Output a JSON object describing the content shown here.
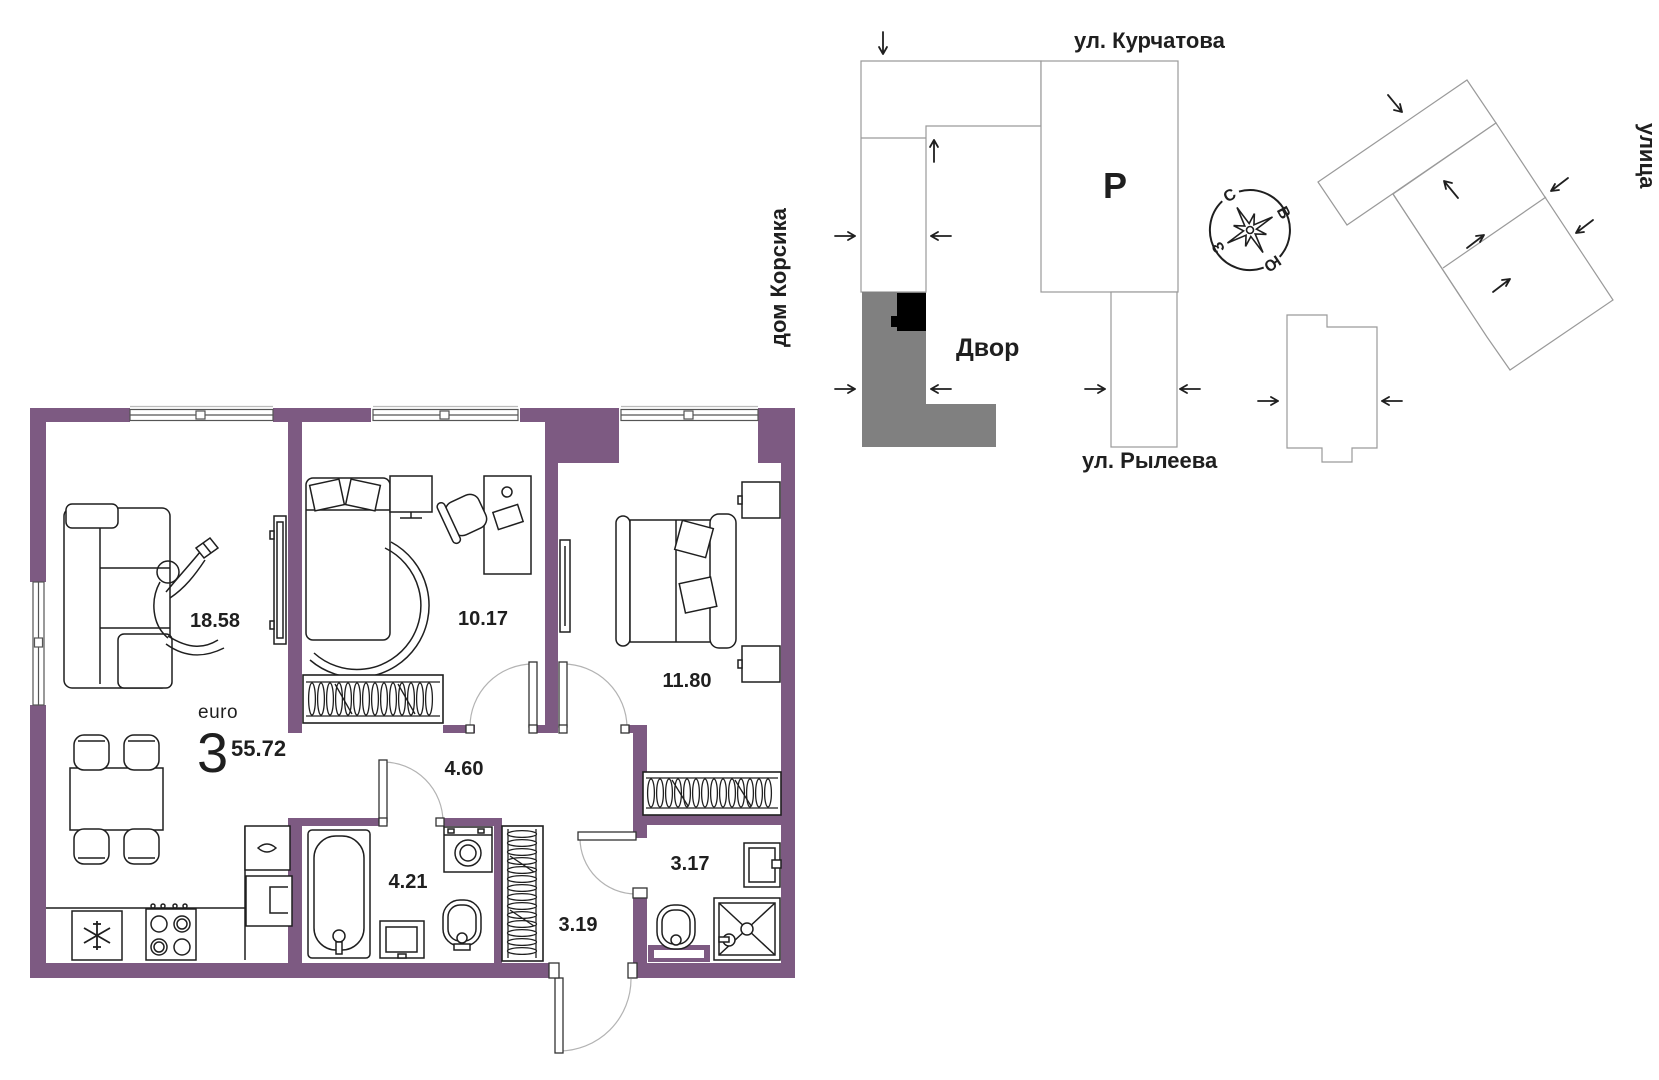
{
  "floor_plan": {
    "unit_type_label": "euro",
    "unit_rooms_count": "3",
    "unit_total_area": "55.72",
    "rooms": {
      "living_kitchen": "18.58",
      "bedroom_small": "10.17",
      "bedroom_master": "11.80",
      "hallway": "4.60",
      "bathroom": "4.21",
      "entry_hall": "3.19",
      "wc": "3.17"
    }
  },
  "site_plan": {
    "street_top": "ул. Курчатова",
    "street_bottom": "ул. Рылеева",
    "house_label": "дом Корсика",
    "street_right": "улица",
    "courtyard_label": "Двор",
    "parking_label": "Р",
    "compass": {
      "north": "С",
      "east": "В",
      "south": "Ю",
      "west": "З"
    }
  },
  "colors": {
    "wall": "#7d5a82",
    "accent_text": "#7d5a82",
    "ink": "#1f1f1f",
    "site_building_fill": "#808080",
    "apartment_marker": "#000000",
    "site_outline": "#9a9a9a"
  }
}
